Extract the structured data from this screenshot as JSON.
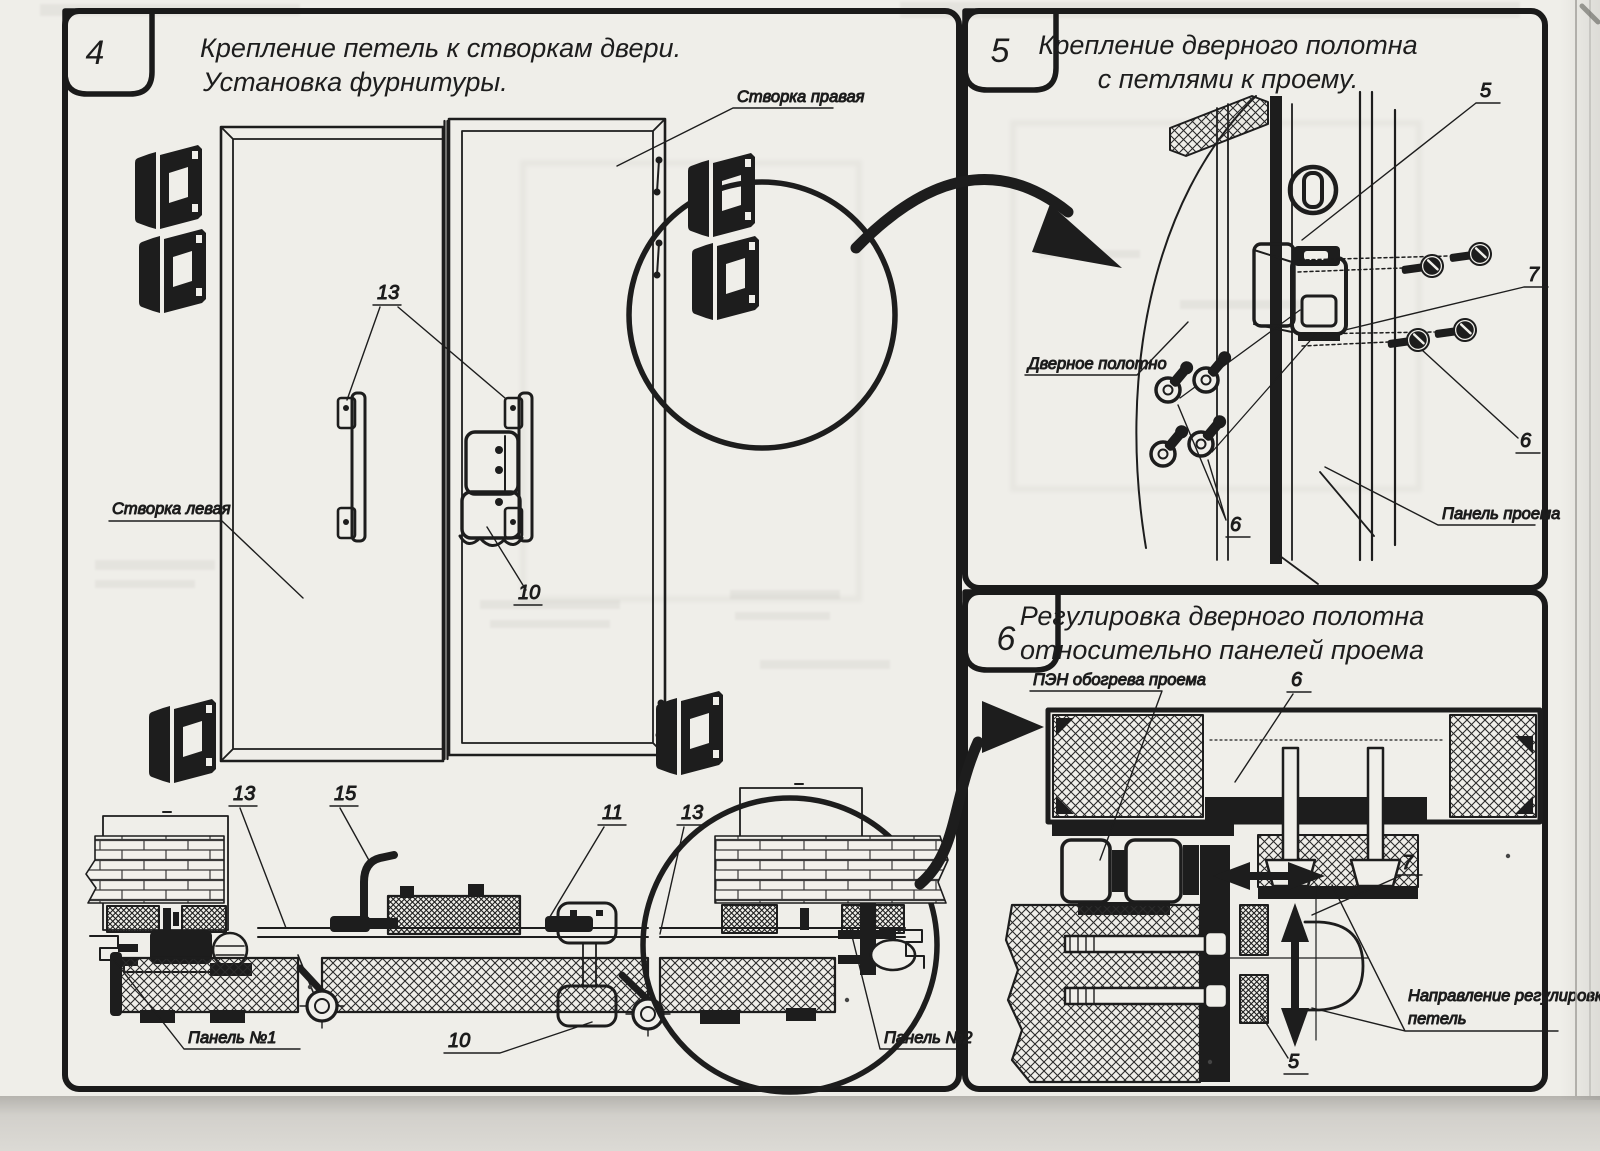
{
  "panels": {
    "p4": {
      "number": "4",
      "title_line1": "Крепление петель к створкам двери.",
      "title_line2": "Установка фурнитуры.",
      "labels": {
        "leaf_right": "Створка правая",
        "leaf_left": "Створка левая",
        "panel_no1": "Панель №1",
        "panel_no2": "Панель №2"
      },
      "callouts": {
        "c13_handles": "13",
        "c10_latch": "10",
        "c13_bottom_left": "13",
        "c15_hook": "15",
        "c11_bracket": "11",
        "c13_bottom_right": "13",
        "c10_keeper": "10"
      }
    },
    "p5": {
      "number": "5",
      "title_line1": "Крепление дверного полотна",
      "title_line2": "с петлями к проему.",
      "labels": {
        "door_leaf": "Дверное полотно",
        "opening_panel": "Панель проема"
      },
      "callouts": {
        "c5_hinge": "5",
        "c7_screws": "7",
        "c6_screws": "6",
        "c6_washers": "6"
      }
    },
    "p6": {
      "number": "6",
      "title_line1": "Регулировка дверного полотна",
      "title_line2": "относительно панелей проема",
      "labels": {
        "heater": "ПЭН обогрева проема",
        "direction_line1": "Направление регулировки",
        "direction_line2": "петель"
      },
      "callouts": {
        "c6_bolt": "6",
        "c7_hinge": "7",
        "c5_hinge": "5"
      }
    },
    "colors": {
      "paper": "#f0efea",
      "ink": "#1d1d1d"
    }
  }
}
